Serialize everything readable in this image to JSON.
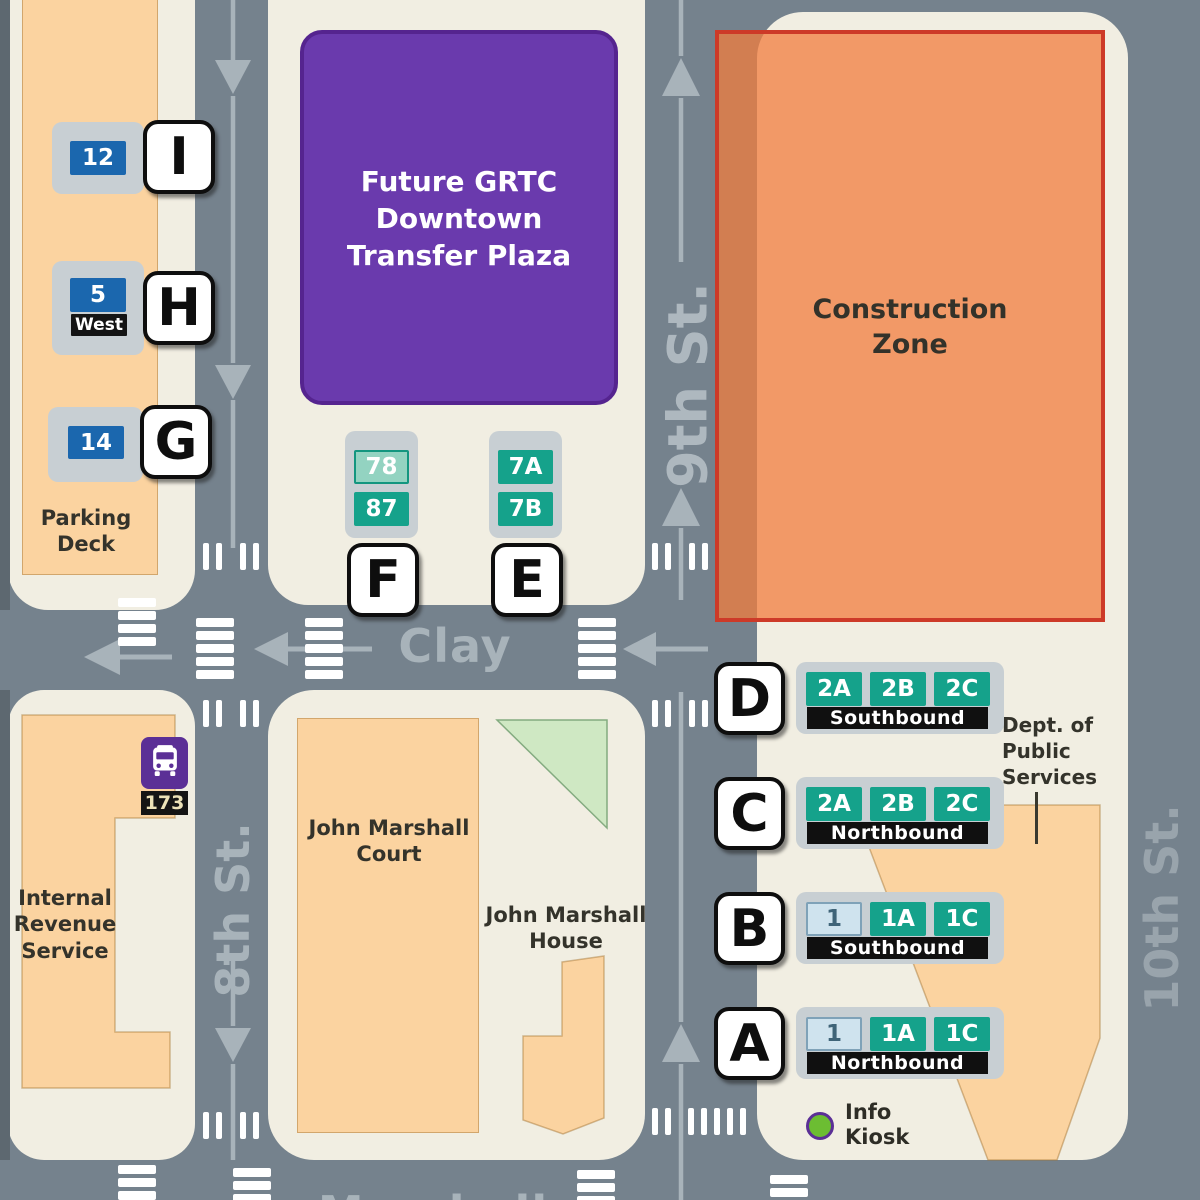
{
  "streets": {
    "eighth": "8th St.",
    "ninth": "9th St.",
    "tenth": "10th St.",
    "clay": "Clay",
    "marshall": "Marshall"
  },
  "areas": {
    "plaza": {
      "label": "Future GRTC\nDowntown\nTransfer Plaza",
      "color": "#6a3aad"
    },
    "construction": {
      "label": "Construction\nZone",
      "color": "#f07c3e",
      "border": "#cd3a28"
    }
  },
  "buildings": {
    "parking_deck": {
      "label": "Parking\nDeck"
    },
    "irs": {
      "label": "Internal\nRevenue\nService"
    },
    "jm_court": {
      "label": "John Marshall\nCourt"
    },
    "jm_house": {
      "label": "John Marshall\nHouse"
    },
    "dps": {
      "label": "Dept. of\nPublic\nServices"
    }
  },
  "stops": [
    {
      "letter": "A",
      "direction": "Northbound",
      "routes": [
        {
          "id": "1",
          "style": "lightblue"
        },
        {
          "id": "1A",
          "style": "teal"
        },
        {
          "id": "1C",
          "style": "teal"
        }
      ]
    },
    {
      "letter": "B",
      "direction": "Southbound",
      "routes": [
        {
          "id": "1",
          "style": "lightblue"
        },
        {
          "id": "1A",
          "style": "teal"
        },
        {
          "id": "1C",
          "style": "teal"
        }
      ]
    },
    {
      "letter": "C",
      "direction": "Northbound",
      "routes": [
        {
          "id": "2A",
          "style": "teal"
        },
        {
          "id": "2B",
          "style": "teal"
        },
        {
          "id": "2C",
          "style": "teal"
        }
      ]
    },
    {
      "letter": "D",
      "direction": "Southbound",
      "routes": [
        {
          "id": "2A",
          "style": "teal"
        },
        {
          "id": "2B",
          "style": "teal"
        },
        {
          "id": "2C",
          "style": "teal"
        }
      ]
    },
    {
      "letter": "E",
      "routes": [
        {
          "id": "7A",
          "style": "teal"
        },
        {
          "id": "7B",
          "style": "teal"
        }
      ]
    },
    {
      "letter": "F",
      "routes": [
        {
          "id": "78",
          "style": "teal-light"
        },
        {
          "id": "87",
          "style": "teal"
        }
      ]
    },
    {
      "letter": "G",
      "routes": [
        {
          "id": "14",
          "style": "blue"
        }
      ]
    },
    {
      "letter": "H",
      "sub": "West",
      "routes": [
        {
          "id": "5",
          "style": "blue"
        }
      ]
    },
    {
      "letter": "I",
      "routes": [
        {
          "id": "12",
          "style": "blue"
        }
      ]
    }
  ],
  "bus_sign": {
    "route": "173"
  },
  "legend": {
    "info_kiosk": "Info\nKiosk"
  },
  "colors": {
    "street": "#75828d",
    "block": "#f1eee2",
    "building": "#fbd3a0",
    "route_teal": "#15a28b",
    "route_blue": "#1b67ae",
    "grtc_purple": "#5b2f96",
    "kiosk_green": "#6cbd32",
    "park_green": "#cfe8c3",
    "marking": "#a8b3ba"
  }
}
